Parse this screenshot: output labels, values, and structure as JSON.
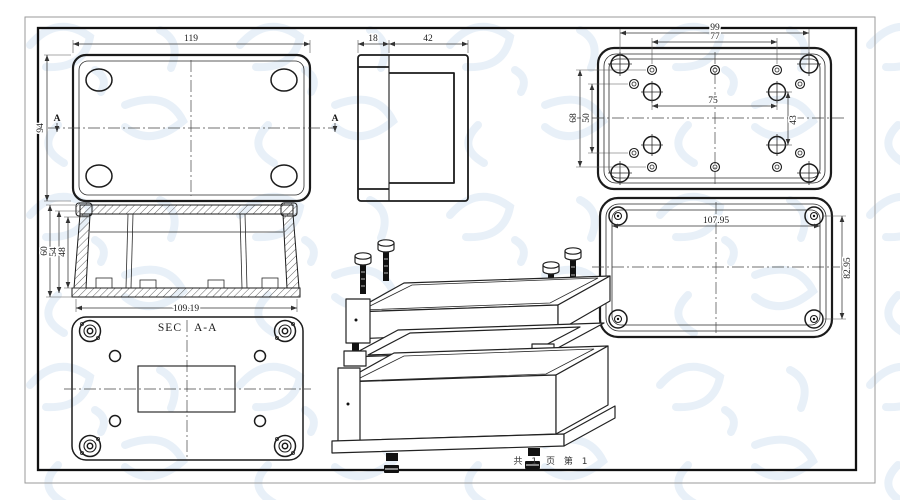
{
  "footer": {
    "page_label": "共 1 页  第 1"
  },
  "colors": {
    "line": "#1b1b1b",
    "dimension": "#333333",
    "watermark": "#d9e6f3",
    "paper": "#ffffff"
  },
  "top_view": {
    "dim_width": "119",
    "dim_height": "94",
    "section_marker": "A"
  },
  "side_view": {
    "dim_lid": "18",
    "dim_base": "42"
  },
  "base_interior_view": {
    "dim_width_outer": "99",
    "dim_width_holes": "77",
    "dim_width_bosses": "75",
    "dim_height_holes": "68",
    "dim_height_inner": "50",
    "dim_height_bosses": "43"
  },
  "lid_exterior_view": {
    "dim_width": "107.95",
    "dim_height": "82.95"
  },
  "section_view": {
    "label_prefix": "SEC",
    "label_suffix": "A-A",
    "dim_depth_outer": "60",
    "dim_depth_mid": "54",
    "dim_depth_inner": "48",
    "dim_width_inner": "109.19"
  }
}
